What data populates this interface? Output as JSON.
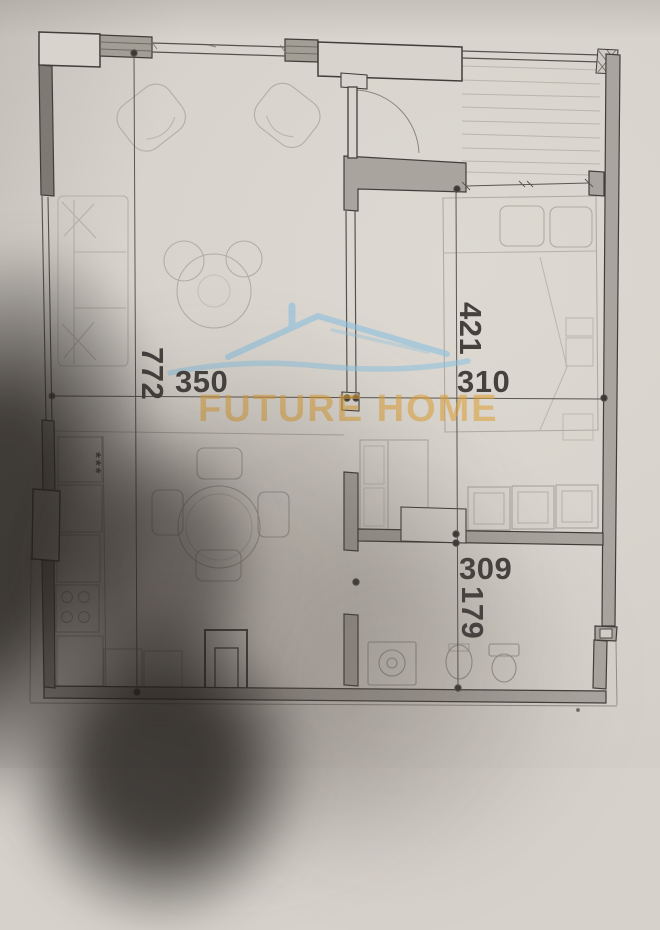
{
  "watermark": {
    "brand": "FUTURE HOME",
    "accent_orange": "#dda03a",
    "accent_blue": "#8cc0de"
  },
  "dimension_labels": {
    "overall_height": "772",
    "living_width": "350",
    "bedroom_depth": "421",
    "bedroom_width": "310",
    "bathroom_width": "309",
    "bathroom_depth": "179"
  },
  "annotations": {
    "kitchen_star_marks": "***"
  },
  "colors": {
    "paper": "#d6d2cb",
    "ink": "#413e3a",
    "wall_fill": "#a9a59e",
    "faint_furniture_line": "#b2aea6",
    "dimension_text": "#45423e"
  }
}
